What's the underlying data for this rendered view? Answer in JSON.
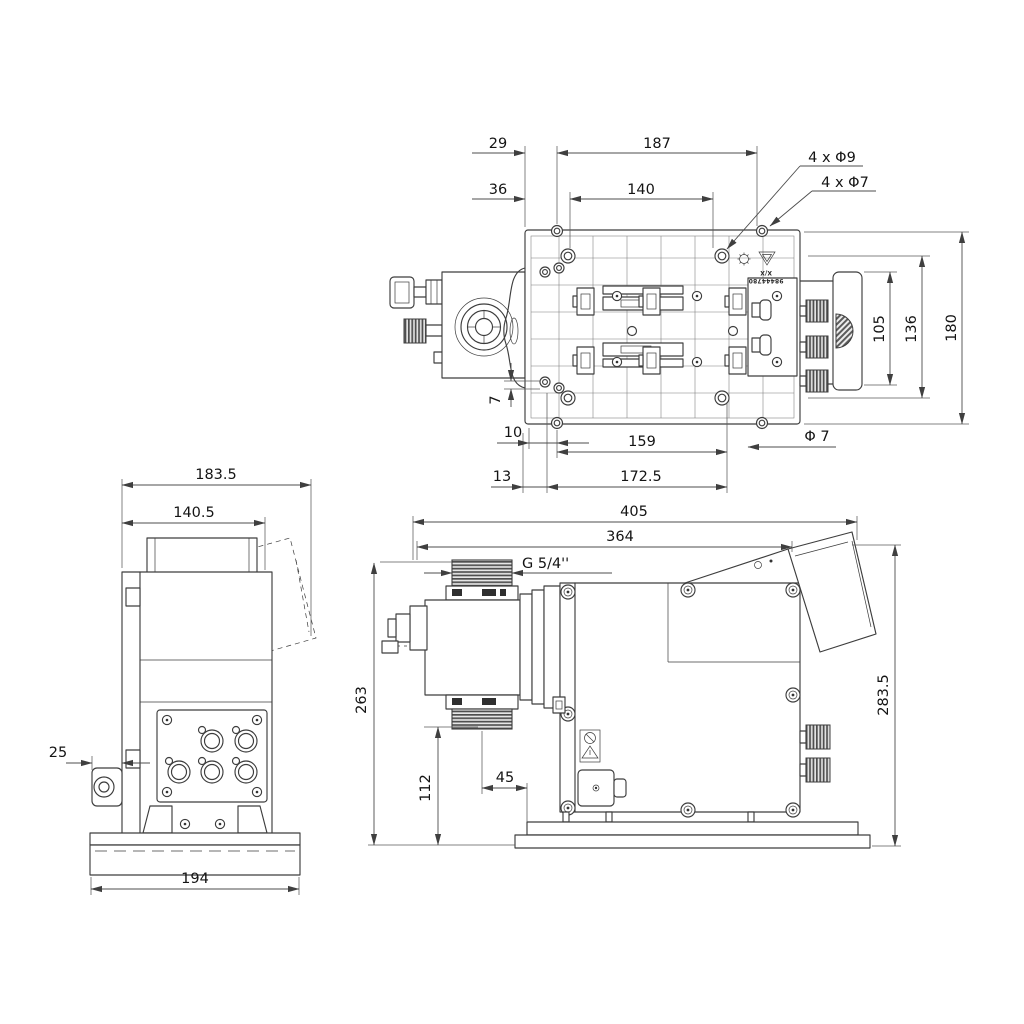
{
  "colors": {
    "line": "#3d3d3d",
    "dimension": "#4c4c4c",
    "text": "#141414",
    "background": "#ffffff"
  },
  "top_view": {
    "dims": {
      "w29": "29",
      "w187": "187",
      "w36": "36",
      "w140": "140",
      "h105": "105",
      "h136": "136",
      "h180": "180",
      "v7": "7",
      "w10": "10",
      "w159": "159",
      "w13": "13",
      "w172_5": "172.5"
    },
    "labels": {
      "holes9": "4 x Φ9",
      "holes7": "4 x Φ7",
      "dia7": "Φ 7"
    },
    "part_marking": {
      "line1": "X/X",
      "line2": "98444780"
    }
  },
  "side_view": {
    "dims": {
      "w183_5": "183.5",
      "w140_5": "140.5",
      "w25": "25",
      "w194": "194"
    }
  },
  "front_view": {
    "dims": {
      "w405": "405",
      "w364": "364",
      "h263": "263",
      "h112": "112",
      "w45": "45",
      "h283_5": "283.5"
    },
    "labels": {
      "thread": "G 5/4''"
    }
  }
}
